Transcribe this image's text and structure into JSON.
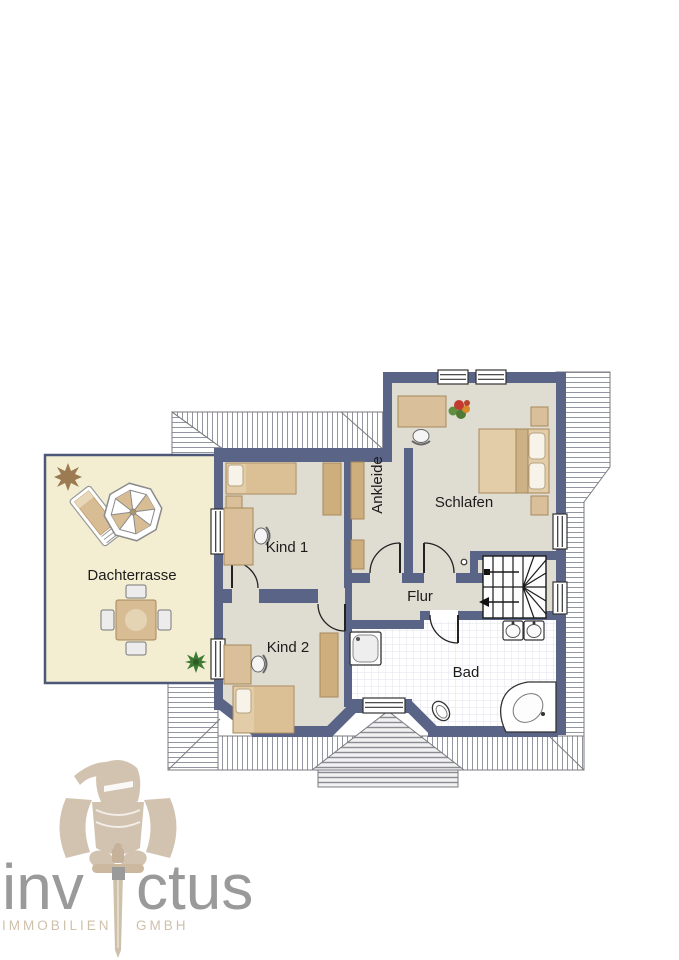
{
  "rooms": {
    "dachterrasse": "Dachterrasse",
    "kind1": "Kind 1",
    "kind2": "Kind 2",
    "ankleide": "Ankleide",
    "schlafen": "Schlafen",
    "flur": "Flur",
    "bad": "Bad"
  },
  "logo": {
    "brand_left": "inv",
    "brand_right": "ctus",
    "subtitle_left": "IMMOBILIEN",
    "subtitle_right": "GMBH"
  },
  "colors": {
    "wall": "#5a6487",
    "room_floor": "#dfdcd2",
    "terrace_floor": "#f3eed2",
    "furniture_tan": "#d9bd92",
    "roof_hatch_line": "#9296a0",
    "logo_gray": "#9a9a9a",
    "logo_beige": "#d2c3b0"
  }
}
